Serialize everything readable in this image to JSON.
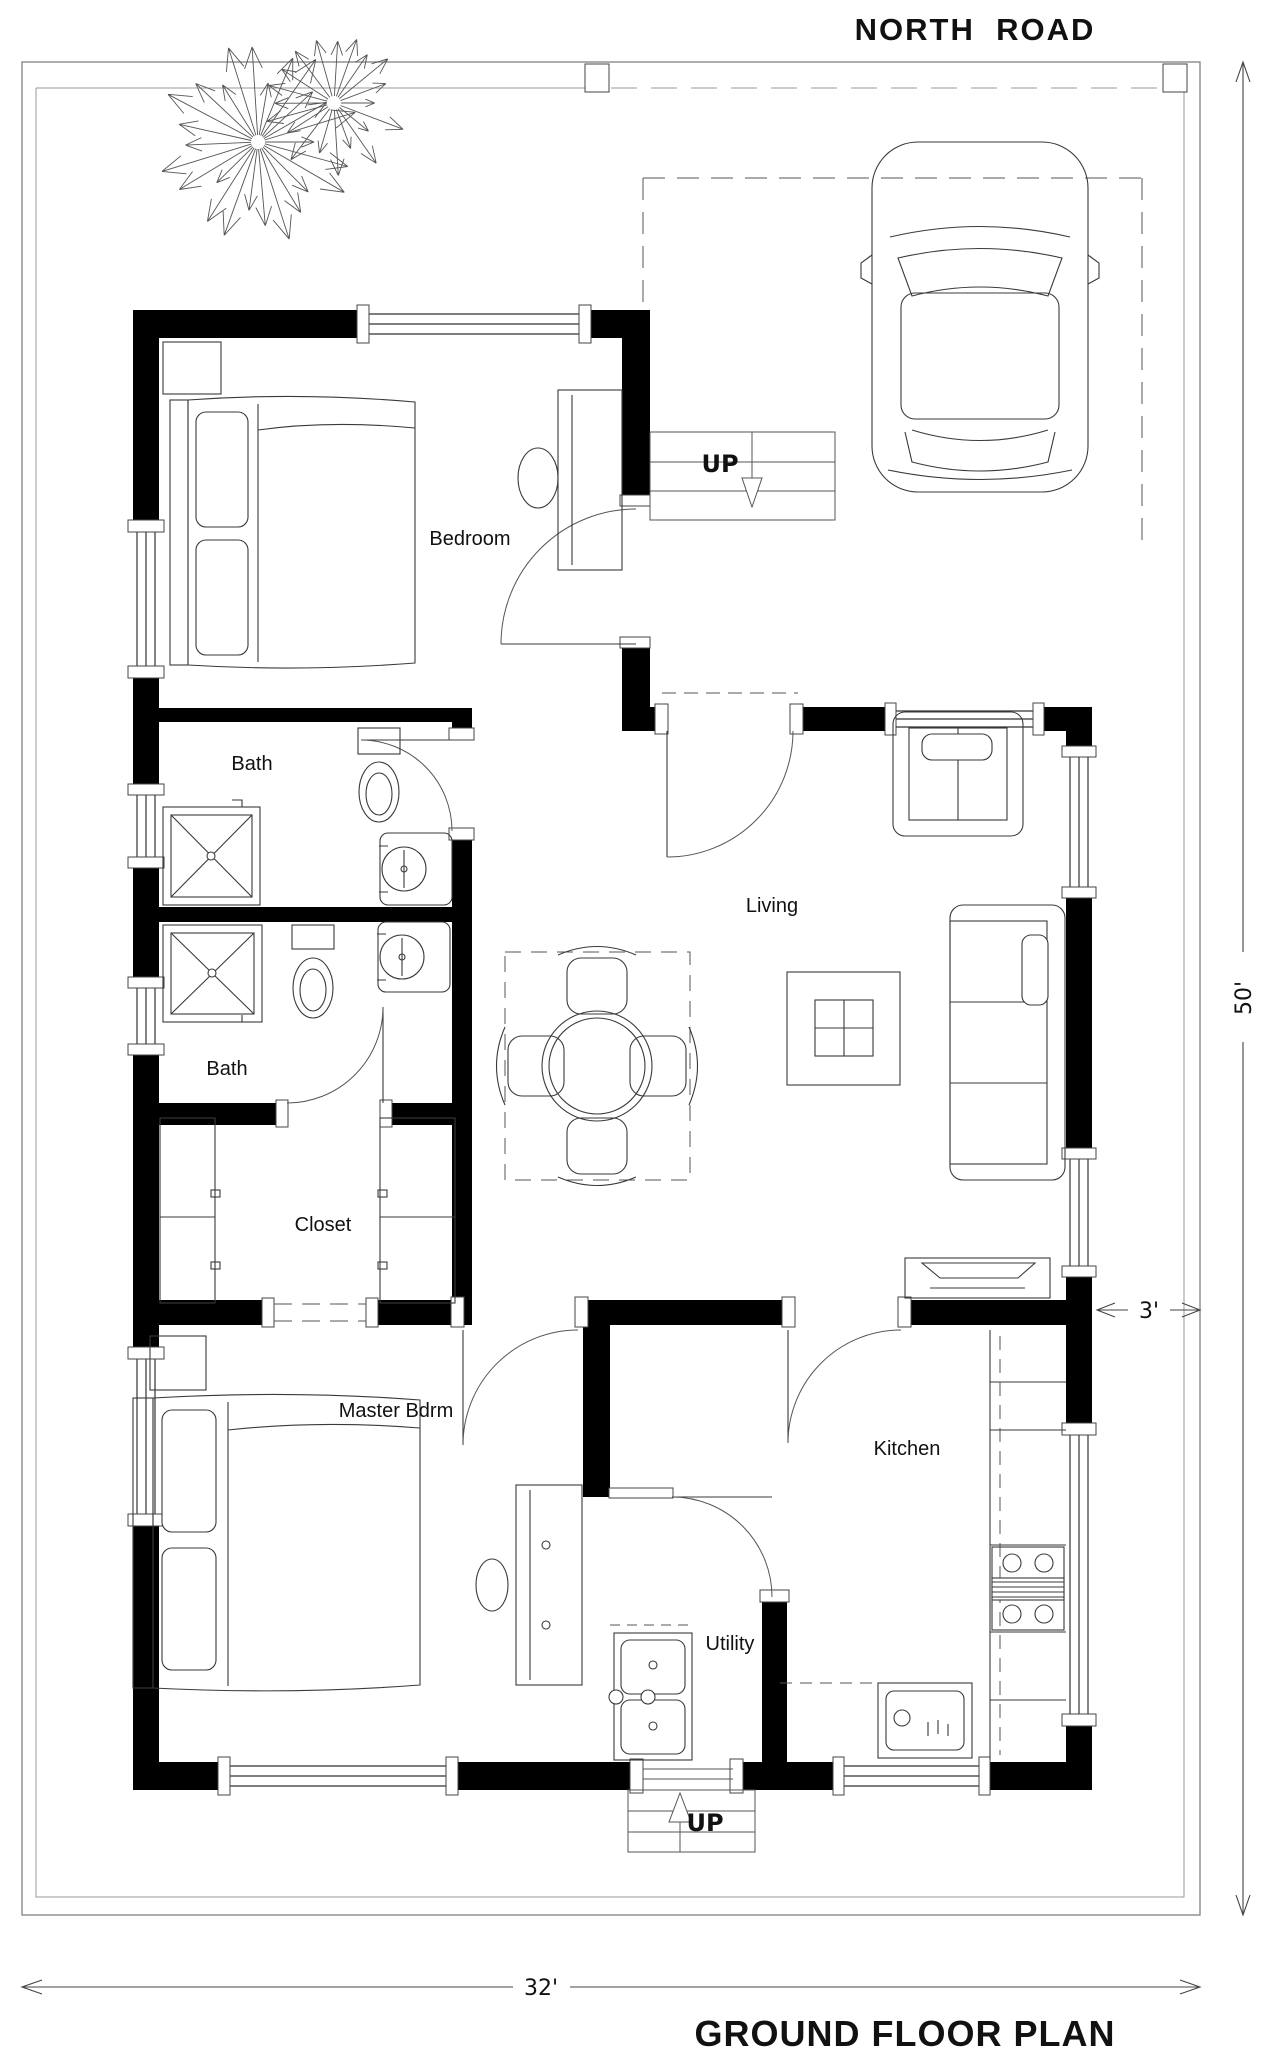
{
  "header": {
    "road_label": "NORTH  ROAD"
  },
  "footer": {
    "plan_title": "GROUND FLOOR PLAN"
  },
  "rooms": {
    "bedroom": "Bedroom",
    "bath_upper": "Bath",
    "bath_lower": "Bath",
    "closet": "Closet",
    "master_bedroom": "Master Bdrm",
    "living": "Living",
    "kitchen": "Kitchen",
    "utility": "Utility"
  },
  "stairs": {
    "upper_label": "UP",
    "lower_label": "UP"
  },
  "dimensions": {
    "plot_depth": "50'",
    "plot_width": "32'",
    "side_setback": "3'"
  },
  "colors": {
    "wall": "#000000",
    "line": "#3a3a3a",
    "boundary": "#8a8a8a",
    "background": "#ffffff"
  }
}
